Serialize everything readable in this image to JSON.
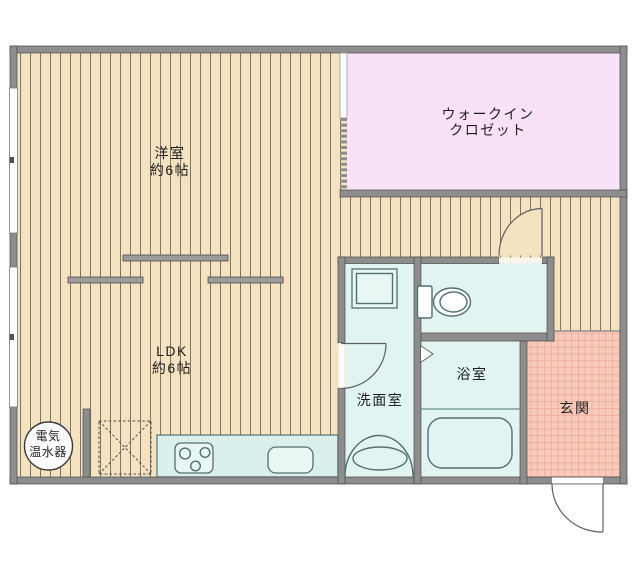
{
  "floorplan": {
    "rooms": {
      "western_room": {
        "label": "洋室",
        "size": "約6帖"
      },
      "walk_in_closet": {
        "label_line1": "ウォークイン",
        "label_line2": "クロゼット"
      },
      "ldk": {
        "label": "LDK",
        "size": "約6帖"
      },
      "washroom": {
        "label": "洗面室"
      },
      "bathroom": {
        "label": "浴室"
      },
      "entrance": {
        "label": "玄関"
      }
    },
    "equipment": {
      "water_heater": {
        "label_line1": "電気",
        "label_line2": "温水器"
      }
    },
    "icons": [
      "toilet-icon",
      "bathtub-icon",
      "stove-icon",
      "kitchen-sink-icon",
      "vanity-sink-icon",
      "washing-machine-pan-icon",
      "refrigerator-space-icon",
      "water-heater-icon",
      "door-swing-icon",
      "folding-door-icon",
      "window-icon",
      "sliding-partition-icon"
    ],
    "colors": {
      "wood_floor": "#f5e2c1",
      "wood_stripe": "#6f6b59",
      "closet_pink": "#f9e2f7",
      "wet_room_cyan": "#e1f4f1",
      "kitchen_counter_cyan": "#d9f0ec",
      "entrance_salmon": "#f8cbbc",
      "entrance_grid": "#ecab97",
      "wall_gray": "#8d8d8d"
    }
  }
}
